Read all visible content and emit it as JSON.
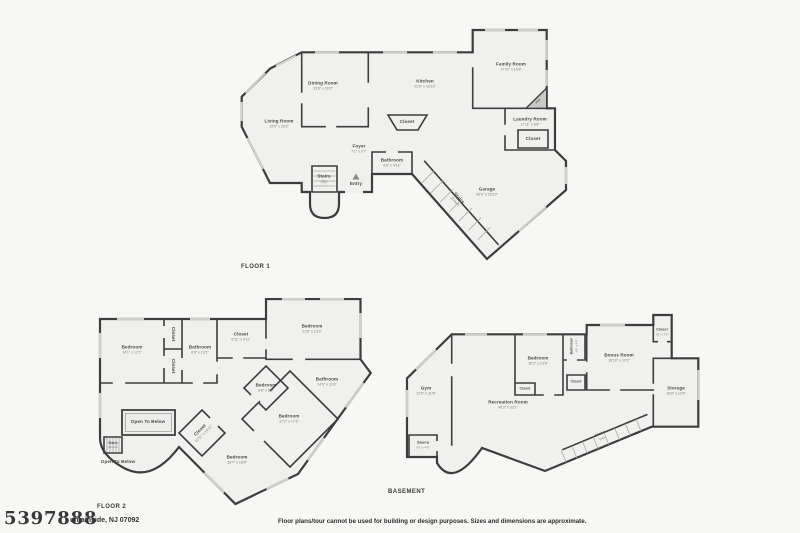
{
  "colors": {
    "background": "#f7f7f5",
    "wall": "#3d3d3d",
    "floor_fill": "#f0f0ee",
    "window": "#cfcfcd"
  },
  "footer": {
    "watermark": "5397888",
    "address_fragment": "untainside, NJ 07092",
    "disclaimer": "Floor plans/tour cannot be used for building or design purposes. Sizes and dimensions are approximate."
  },
  "floor1": {
    "caption": "FLOOR 1",
    "rooms": {
      "living": {
        "name": "Living Room",
        "dims": "13'5\" x 20'2\""
      },
      "dining": {
        "name": "Dining Room",
        "dims": "13'6\" x 16'3\""
      },
      "kitchen": {
        "name": "Kitchen",
        "dims": "22'8\" x 16'10\""
      },
      "family": {
        "name": "Family Room",
        "dims": "17'11\" x 14'8\""
      },
      "laundry": {
        "name": "Laundry Room",
        "dims": "17'11\" x 8'8\""
      },
      "closet_kitchen": {
        "name": "Closet"
      },
      "closet_laundry": {
        "name": "Closet"
      },
      "foyer": {
        "name": "Foyer",
        "dims": "7'1\" x 9'7\""
      },
      "bathroom": {
        "name": "Bathroom",
        "dims": "6'6\" x 4'11\""
      },
      "stairs_up": {
        "name": "Stairs",
        "sub": "(Up)"
      },
      "stairs_down": {
        "name": "Stairs",
        "sub": "(Down)"
      },
      "entry": {
        "name": "Entry"
      },
      "garage": {
        "name": "Garage",
        "dims": "30'0\" x 25'10\""
      },
      "fireplace": {
        "name": "Fire"
      }
    }
  },
  "floor2": {
    "caption": "FLOOR 2",
    "rooms": {
      "bedroom1": {
        "name": "Bedroom",
        "dims": "14'1\" x 12'1\""
      },
      "closet_a": {
        "name": "Closet"
      },
      "closet_b": {
        "name": "Closet"
      },
      "bathroom1": {
        "name": "Bathroom",
        "dims": "8'6\" x 13'1\""
      },
      "closet_hall": {
        "name": "Closet",
        "dims": "6'11\" x 9'11\""
      },
      "bedroom2": {
        "name": "Bedroom",
        "dims": "21'6\" x 13'3\""
      },
      "bathroom2": {
        "name": "Bathroom",
        "dims": "14'9\" x 11'8\""
      },
      "bedroom3": {
        "name": "Bedroom",
        "dims": "9'6\" x 6'5\""
      },
      "bedroom4": {
        "name": "Bedroom",
        "dims": "17'2\" x 17'2\""
      },
      "bedroom5": {
        "name": "Bedroom",
        "dims": "18'7\" x 18'8\""
      },
      "closet_diag": {
        "name": "Closet",
        "dims": "12'11\" x 14'11\""
      },
      "open_below_1": {
        "name": "Open To Below"
      },
      "open_below_2": {
        "name": "Open To Below"
      },
      "stairs_down": {
        "name": "Stairs",
        "sub": "(Down)"
      }
    }
  },
  "basement": {
    "caption": "BASEMENT",
    "rooms": {
      "gym": {
        "name": "Gym",
        "dims": "12'6\" x 11'6\""
      },
      "recreation": {
        "name": "Recreation Room",
        "dims": "45'3\" x 33'1\""
      },
      "bedroom": {
        "name": "Bedroom",
        "dims": "16'2\" x 13'9\""
      },
      "closet_bedroom": {
        "name": "Closet"
      },
      "bathroom": {
        "name": "Bathroom",
        "dims": "4'9\" x 4'9\""
      },
      "closet_bath": {
        "name": "Closet"
      },
      "bonus": {
        "name": "Bonus Room",
        "dims": "18'10\" x 13'3\""
      },
      "closet_top": {
        "name": "Closet",
        "dims": "4'5\" x 7'9\""
      },
      "storage": {
        "name": "Storage",
        "dims": "18'8\" x 13'5\""
      },
      "sauna": {
        "name": "Sauna",
        "dims": "8'3\" x 4'9\""
      },
      "stairs_up": {
        "name": "Stairs",
        "sub": "(Up)"
      }
    }
  }
}
